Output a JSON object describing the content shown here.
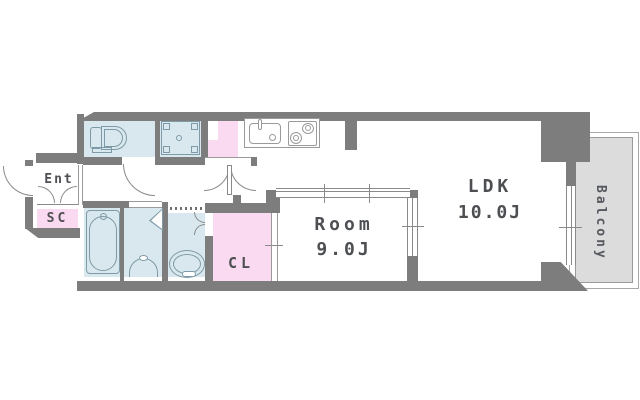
{
  "labels": {
    "entrance": "Ent",
    "shoe_closet": "SC",
    "closet": "CL",
    "room_name": "Room",
    "room_area": "9.0J",
    "ldk_name": "LDK",
    "ldk_area": "10.0J",
    "balcony": "Balcony"
  },
  "rooms": [
    {
      "name": "entrance",
      "label": "Ent"
    },
    {
      "name": "shoe-closet",
      "label": "SC"
    },
    {
      "name": "toilet-room",
      "label": ""
    },
    {
      "name": "washer-space",
      "label": ""
    },
    {
      "name": "storage",
      "label": ""
    },
    {
      "name": "kitchen",
      "label": ""
    },
    {
      "name": "bathroom",
      "label": ""
    },
    {
      "name": "washroom",
      "label": ""
    },
    {
      "name": "powder-room",
      "label": ""
    },
    {
      "name": "closet",
      "label": "CL"
    },
    {
      "name": "bedroom",
      "label": "Room",
      "area": "9.0J"
    },
    {
      "name": "living-dining-kitchen",
      "label": "LDK",
      "area": "10.0J"
    },
    {
      "name": "balcony",
      "label": "Balcony"
    }
  ],
  "fixtures": [
    "toilet",
    "washing-machine-pan",
    "kitchen-sink",
    "gas-stove",
    "bathtub",
    "washbasin",
    "vanity-bowl"
  ],
  "colors": {
    "wall": "#7d7d7d",
    "wet_area_fill": "#d9e8ee",
    "closet_pink_fill": "#f9daf0",
    "balcony_fill": "#dcdcdc",
    "label_text": "#4d4f52",
    "fixture_line": "#7e9aa6",
    "door_line": "#8a8a8a"
  }
}
